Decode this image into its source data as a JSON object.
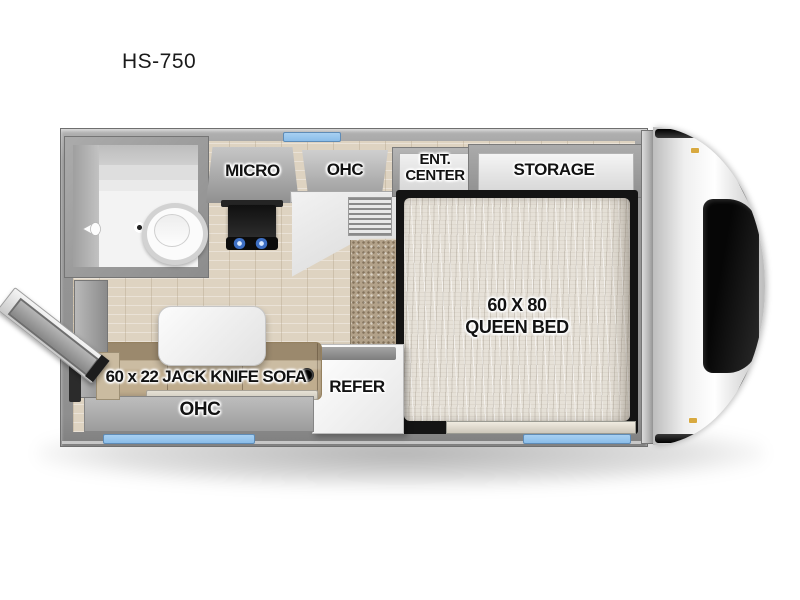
{
  "page": {
    "title": "HS-750"
  },
  "floorplan": {
    "model": "HS-750",
    "labels": {
      "micro": "MICRO",
      "ohc_top": "OHC",
      "ent_center_line1": "ENT.",
      "ent_center_line2": "CENTER",
      "storage": "STORAGE",
      "bed_line1": "60 X 80",
      "bed_line2": "QUEEN BED",
      "refer": "REFER",
      "sofa": "60 x 22 JACK KNIFE SOFA",
      "ohc_bottom": "OHC"
    },
    "colors": {
      "window_blue": "#8abde9",
      "wall_gray": "#979797",
      "floor_wood": "#ded3c1",
      "carpet": "#b3a28a",
      "sofa": "#c0ad8e",
      "mattress": "#e6e1d8",
      "label": "#121212"
    }
  }
}
